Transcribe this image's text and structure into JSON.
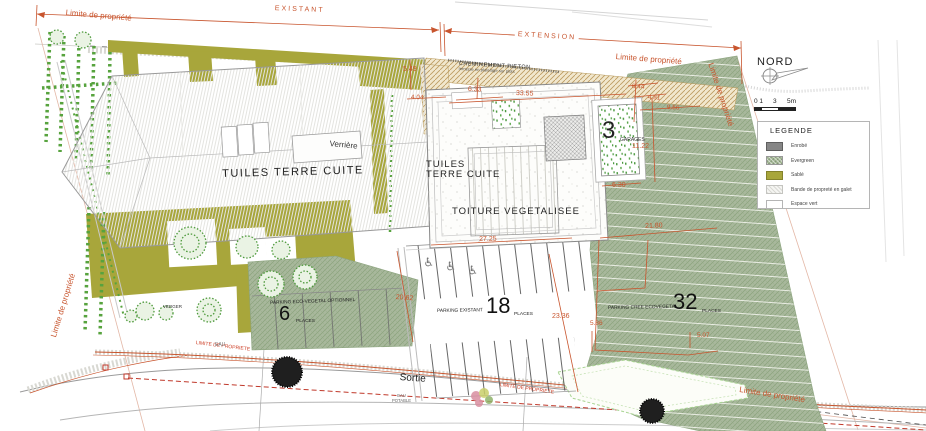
{
  "boundary": {
    "limite": "Limite de propriété",
    "limite_caps": "LIMITE DE PROPRIETE",
    "existant": "EXISTANT",
    "extension": "EXTENSION"
  },
  "compass": {
    "nord": "NORD"
  },
  "scalebar": {
    "t0": "0 1",
    "t3": "3",
    "t5": "5m"
  },
  "legend": {
    "title": "LEGENDE",
    "items": [
      {
        "swatch": "enrobe",
        "label": "Enrobé"
      },
      {
        "swatch": "evergreen",
        "label": "Evergreen"
      },
      {
        "swatch": "sable",
        "label": "Sablé"
      },
      {
        "swatch": "bande",
        "label": "Bande de propreté en galet"
      },
      {
        "swatch": "espace",
        "label": "Espace vert"
      }
    ]
  },
  "building": {
    "tuiles_main": "TUILES TERRE CUITE",
    "verriere": "Verrière",
    "tuiles_ext_l1": "TUILES",
    "tuiles_ext_l2": "TERRE CUITE",
    "toiture": "TOITURE VEGETALISEE",
    "garages_count": "3",
    "garages_label": "GARAGES",
    "cheminement": "CHEMINEMENT PIETON",
    "cheminement_sub": "terrasse en platelage sur plots"
  },
  "parkings": {
    "eco": {
      "name": "PARKING ECO-VEGETAL OPTIONNEL",
      "count": "6",
      "places": "PLACES"
    },
    "existant": {
      "name": "PARKING EXISTANT",
      "count": "18",
      "places": "PLACES"
    },
    "cree": {
      "name": "PARKING CREE ECOVEGETAL",
      "count": "32",
      "places": "PLACES"
    }
  },
  "dims": {
    "d549": "5.49",
    "d404": "4.04",
    "d633": "6.33",
    "d3355": "33.55",
    "d644": "6.44",
    "d481": "4.81",
    "d956": "9.56",
    "d1122": "11.22",
    "d630": "6.30",
    "d2180": "21.80",
    "d2725": "27.25",
    "d2062": "20.62",
    "d2336": "23.36",
    "d586": "5.86",
    "d507": "5.07"
  },
  "road": {
    "sortie": "Sortie",
    "eau": "EAU",
    "eau_potable_l1": "EAU",
    "eau_potable_l2": "POTABLE"
  },
  "site": {
    "verger": "VERGER"
  },
  "icons": {
    "wheelchair": "♿"
  },
  "colors": {
    "dim_orange": "#c8552e",
    "olive": "#a8a63b",
    "evergreen": "#a4b796",
    "enrobe": "#868686",
    "red_dash": "#c0392b"
  }
}
